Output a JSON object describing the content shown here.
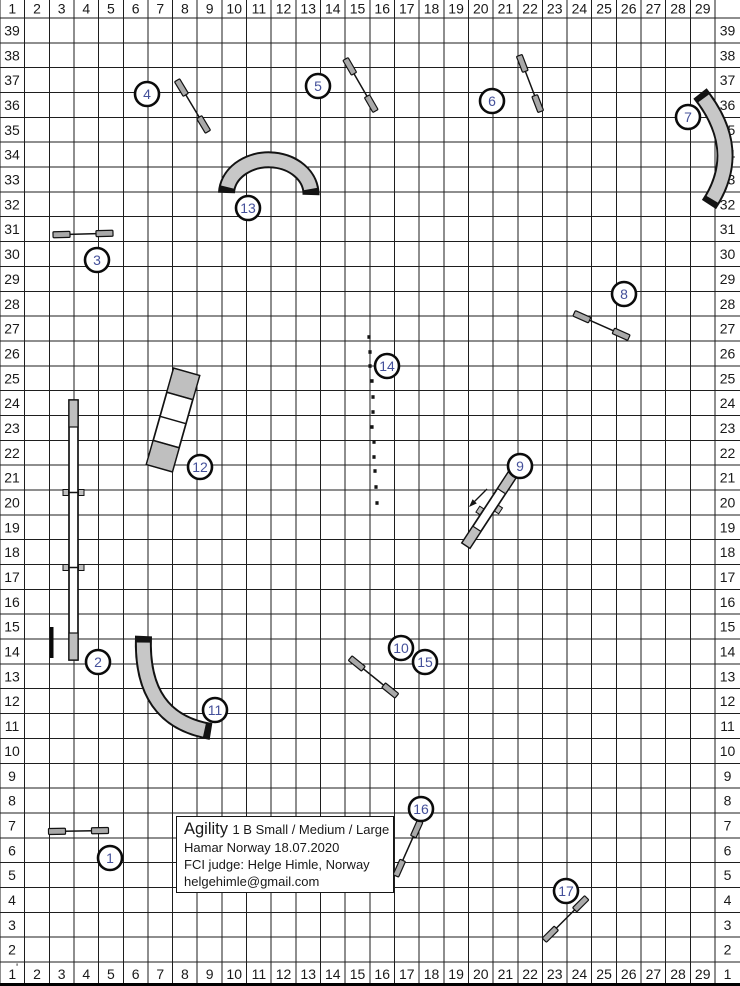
{
  "grid": {
    "columns": [
      "1",
      "2",
      "3",
      "4",
      "5",
      "6",
      "7",
      "8",
      "9",
      "10",
      "11",
      "12",
      "13",
      "14",
      "15",
      "16",
      "17",
      "18",
      "19",
      "20",
      "21",
      "22",
      "23",
      "24",
      "25",
      "26",
      "27",
      "28",
      "29"
    ],
    "rows_left": [
      "39",
      "38",
      "37",
      "36",
      "35",
      "34",
      "33",
      "32",
      "31",
      "30",
      "29",
      "28",
      "27",
      "26",
      "25",
      "24",
      "23",
      "22",
      "21",
      "20",
      "19",
      "18",
      "17",
      "16",
      "15",
      "14",
      "13",
      "12",
      "11",
      "10",
      "9",
      "8",
      "7",
      "6",
      "5",
      "4",
      "3",
      "2"
    ],
    "rows_right": [
      "39",
      "38",
      "37",
      "36",
      "35",
      "34",
      "33",
      "32",
      "31",
      "30",
      "29",
      "28",
      "27",
      "26",
      "25",
      "24",
      "23",
      "22",
      "21",
      "20",
      "19",
      "18",
      "17",
      "16",
      "15",
      "14",
      "13",
      "12",
      "11",
      "10",
      "9",
      "8",
      "7",
      "6",
      "5",
      "4",
      "3",
      "2",
      "1"
    ],
    "corner_tick": "'"
  },
  "info_box": {
    "title_main": "Agility",
    "title_detail": "1 B Small / Medium / Large",
    "location_date": "Hamar Norway 18.07.2020",
    "judge": "FCI judge: Helge Himle, Norway",
    "email": "helgehimle@gmail.com"
  },
  "obstacles": [
    {
      "number": "1",
      "type": "jump",
      "cx": 110,
      "cy": 858
    },
    {
      "number": "2",
      "type": "dog-walk",
      "cx": 98,
      "cy": 662
    },
    {
      "number": "3",
      "type": "jump",
      "cx": 97,
      "cy": 260
    },
    {
      "number": "4",
      "type": "jump",
      "cx": 147,
      "cy": 94
    },
    {
      "number": "5",
      "type": "jump",
      "cx": 318,
      "cy": 86
    },
    {
      "number": "6",
      "type": "jump",
      "cx": 492,
      "cy": 101
    },
    {
      "number": "7",
      "type": "curved-tunnel",
      "cx": 688,
      "cy": 117
    },
    {
      "number": "8",
      "type": "jump",
      "cx": 624,
      "cy": 294
    },
    {
      "number": "9",
      "type": "seesaw",
      "cx": 520,
      "cy": 466
    },
    {
      "number": "10",
      "type": "jump",
      "cx": 401,
      "cy": 648
    },
    {
      "number": "11",
      "type": "curved-tunnel",
      "cx": 215,
      "cy": 710
    },
    {
      "number": "12",
      "type": "a-frame",
      "cx": 200,
      "cy": 467
    },
    {
      "number": "13",
      "type": "curved-tunnel",
      "cx": 248,
      "cy": 208
    },
    {
      "number": "14",
      "type": "weave-poles",
      "cx": 387,
      "cy": 366
    },
    {
      "number": "15",
      "type": "jump",
      "cx": 425,
      "cy": 662
    },
    {
      "number": "16",
      "type": "jump",
      "cx": 421,
      "cy": 809
    },
    {
      "number": "17",
      "type": "jump",
      "cx": 566,
      "cy": 891
    }
  ],
  "weave_poles": {
    "count": 12,
    "dots": [
      [
        369,
        337
      ],
      [
        370,
        352
      ],
      [
        370,
        366
      ],
      [
        372,
        381
      ],
      [
        373,
        397
      ],
      [
        373,
        412
      ],
      [
        372,
        427
      ],
      [
        374,
        442
      ],
      [
        374,
        457
      ],
      [
        375,
        471
      ],
      [
        376,
        487
      ],
      [
        377,
        503
      ]
    ]
  },
  "colors": {
    "outline": "#131313",
    "wing": "#a9a9a9",
    "tunnel": "#c7c7c7",
    "contact": "#bfbfbf",
    "number": "#44509a",
    "grid": "#1e1e1e",
    "text": "#191919"
  }
}
